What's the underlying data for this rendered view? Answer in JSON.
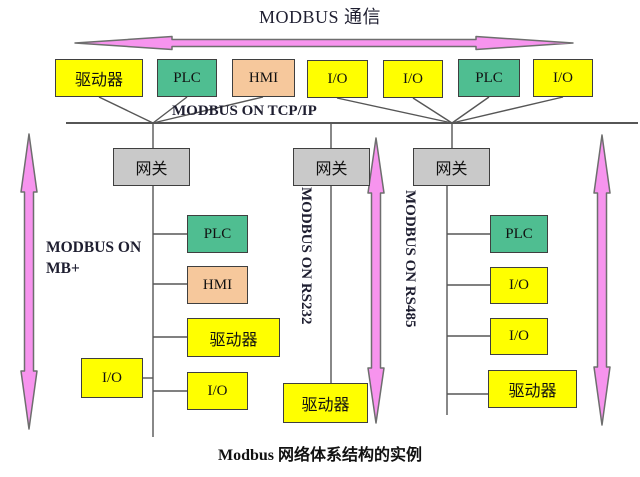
{
  "title": "MODBUS 通信",
  "caption": "Modbus 网络体系结构的实例",
  "bus": {
    "label": "MODBUS ON TCP/IP"
  },
  "top_devices": [
    {
      "label": "驱动器",
      "type": "drive"
    },
    {
      "label": "PLC",
      "type": "plc"
    },
    {
      "label": "HMI",
      "type": "hmi"
    },
    {
      "label": "I/O",
      "type": "io"
    },
    {
      "label": "I/O",
      "type": "io"
    },
    {
      "label": "PLC",
      "type": "plc"
    },
    {
      "label": "I/O",
      "type": "io"
    }
  ],
  "gateways": [
    {
      "label": "网关"
    },
    {
      "label": "网关"
    },
    {
      "label": "网关"
    }
  ],
  "branches": [
    {
      "protocol": "MODBUS ON MB+",
      "devices": [
        {
          "label": "PLC"
        },
        {
          "label": "HMI"
        },
        {
          "label": "驱动器"
        },
        {
          "label": "I/O"
        },
        {
          "label": "I/O"
        }
      ]
    },
    {
      "protocol": "MODBUS ON RS232",
      "devices": [
        {
          "label": "驱动器"
        }
      ]
    },
    {
      "protocol": "MODBUS ON RS485",
      "devices": [
        {
          "label": "PLC"
        },
        {
          "label": "I/O"
        },
        {
          "label": "I/O"
        },
        {
          "label": "驱动器"
        }
      ]
    }
  ],
  "colors": {
    "device_yellow": "#ffff00",
    "device_green": "#4fbe91",
    "device_peach": "#f6c89c",
    "gateway_gray": "#c9c9c9",
    "arrow_pink": "#f794ee",
    "line": "#565656"
  }
}
